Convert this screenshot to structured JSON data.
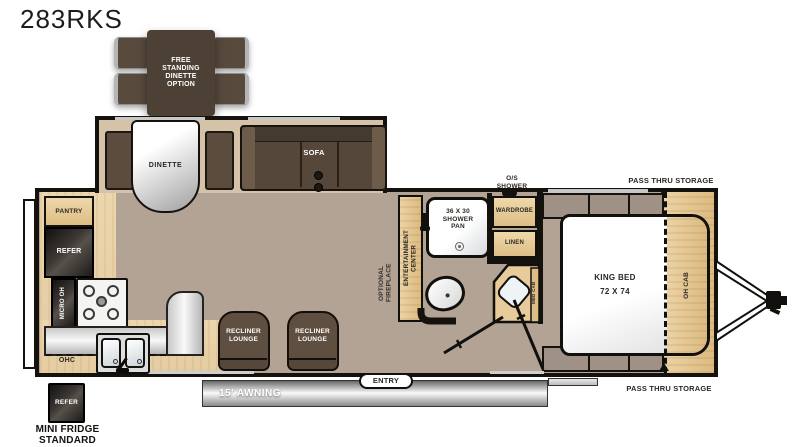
{
  "title": "283RKS",
  "colors": {
    "floor_taupe": "#b2a395",
    "kitchen_wood": "#ead4ab",
    "cabinet_wood": "#e6c897",
    "wall": "#15120e",
    "upholstery": "#5a4b3e",
    "counter_gray": "#d9d9d9",
    "awning_gray": "#8a8a8a"
  },
  "dinette_option": {
    "label": "FREE\nSTANDING\nDINETTE\nOPTION"
  },
  "slideout": {
    "dinette_label": "DINETTE",
    "sofa_label": "SOFA"
  },
  "kitchen": {
    "pantry": "PANTRY",
    "refrigerator": "REFER",
    "microwave": "MICRO OH",
    "overhead_cabinet": "OHC"
  },
  "mini_fridge": {
    "box_label": "REFER",
    "caption": "MINI FRIDGE\nSTANDARD"
  },
  "living": {
    "recliner_left": "RECLINER\nLOUNGE",
    "recliner_right": "RECLINER\nLOUNGE",
    "fireplace": "OPTIONAL\nFIREPLACE",
    "entertainment": "ENTERTAINMENT\nCENTER"
  },
  "bath": {
    "shower_pan": "36 X 30\nSHOWER\nPAN",
    "outside_shower": "O/S\nSHOWER",
    "wardrobe": "WARDROBE",
    "linen": "LINEN",
    "med_cab": "MED CAB"
  },
  "bedroom": {
    "bed": "KING BED\n72 X 74",
    "overhead_cabinet": "OH CAB",
    "pass_thru_top": "PASS THRU STORAGE",
    "pass_thru_bottom": "PASS THRU STORAGE"
  },
  "exterior": {
    "entry": "ENTRY",
    "awning": "15' AWNING"
  }
}
